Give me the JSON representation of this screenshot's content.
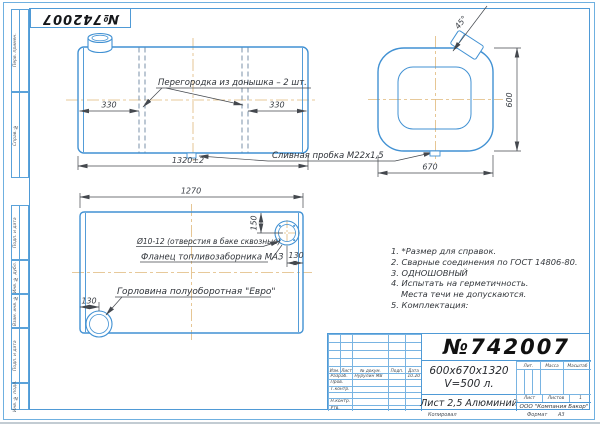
{
  "stamp": {
    "number": "№742007"
  },
  "margin": {
    "labels": [
      "Перв. примен.",
      "Справ. №",
      "Подп. и дата",
      "Инв. № дубл.",
      "Взам. инв. №",
      "Подп. и дата",
      "Инв. № подл."
    ]
  },
  "views": {
    "side": {
      "partition_label": "Перегородка из донышка – 2 шт.",
      "drain_label": "Сливная пробка М22х1,5",
      "dim_left": "330",
      "dim_right": "330",
      "dim_length": "1320±2"
    },
    "end": {
      "dim_width": "670",
      "dim_height": "600",
      "dim_angle": "45°"
    },
    "top": {
      "dim_length": "1270",
      "dim_flange_offset": "150",
      "dim_flange_edge": "130",
      "dim_neck_edge": "130",
      "holes_label": "Ø10-12 (отверстия в баке сквозные)",
      "flange_label": "Фланец топливозаборника МАЗ",
      "neck_label": "Горловина полуоборотная \"Евро\""
    }
  },
  "notes": {
    "lines": [
      "1. *Размер для справок.",
      "2. Сварные соединения по ГОСТ 14806-80.",
      "3. ОДНОШОВНЫЙ",
      "4. Испытать на герметичность.",
      "Места течи не допускаются.",
      "5. Комплектация:"
    ]
  },
  "title_block": {
    "number": "№742007",
    "dimensions": "600х670х1320",
    "volume": "V=500 л.",
    "material": "Лист 2,5 Алюминий",
    "company": "ООО \"Компания Бакор\"",
    "cols": {
      "izm": "Изм.",
      "list": "Лист",
      "dokum": "№ докум.",
      "podp": "Подп.",
      "data": "Дата"
    },
    "rows": {
      "razrab": "Разраб.",
      "prov": "Пров.",
      "tkontr": "Т.контр.",
      "nkontr": "Н.контр.",
      "utv": "Утв."
    },
    "razrab_name": "Нурулин МВ",
    "razrab_date": "10.20",
    "lit": "Лит.",
    "massa": "Масса",
    "masshtab": "Масштаб",
    "list_label": "Лист",
    "listov_label": "Листов",
    "listov_value": "1",
    "kopiroval": "Копировал",
    "format_label": "Формат",
    "format_value": "А3"
  },
  "colors": {
    "frame_blue": "#4f9ad6",
    "line_blue": "#4191d3",
    "centerline_orange": "#e0b87a",
    "dim_dark": "#44484e"
  }
}
